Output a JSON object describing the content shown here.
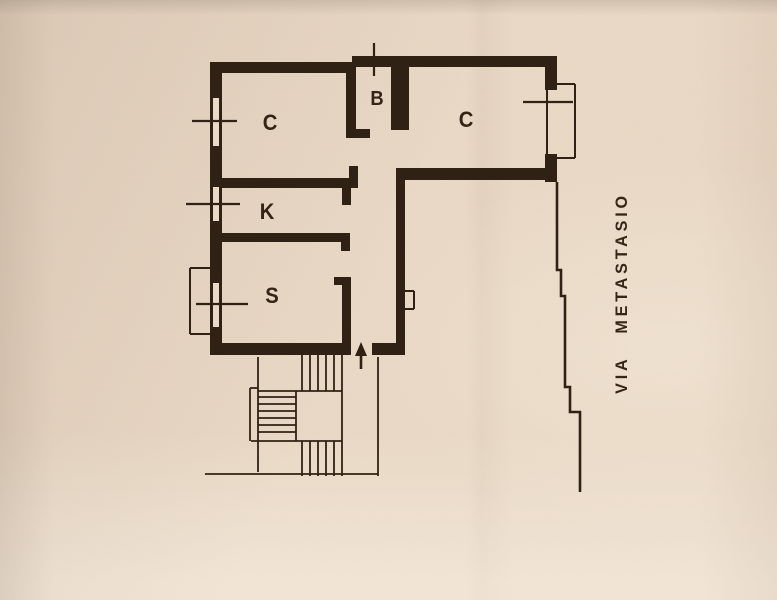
{
  "colors": {
    "paper": "#ead9c6",
    "ink": "#2f2215"
  },
  "street": {
    "label": "VIA METASTASIO"
  },
  "rooms": [
    {
      "id": "room-c-left",
      "label": "C",
      "x": 270,
      "y": 123
    },
    {
      "id": "room-b",
      "label": "B",
      "x": 377,
      "y": 99
    },
    {
      "id": "room-c-right",
      "label": "C",
      "x": 466,
      "y": 120
    },
    {
      "id": "room-k",
      "label": "K",
      "x": 267,
      "y": 212
    },
    {
      "id": "room-s",
      "label": "S",
      "x": 272,
      "y": 296
    }
  ],
  "geometry": {
    "canvas": {
      "w": 777,
      "h": 600
    },
    "walls": [
      [
        210,
        62,
        146,
        11
      ],
      [
        352,
        56,
        205,
        11
      ],
      [
        210,
        62,
        12,
        293
      ],
      [
        210,
        343,
        141,
        12
      ],
      [
        372,
        343,
        33,
        12
      ],
      [
        396,
        168,
        9,
        180
      ],
      [
        396,
        168,
        161,
        12
      ],
      [
        545,
        56,
        12,
        34
      ],
      [
        545,
        154,
        12,
        28
      ],
      [
        391,
        56,
        18,
        74
      ],
      [
        346,
        62,
        10,
        76
      ],
      [
        346,
        129,
        24,
        9
      ],
      [
        222,
        178,
        136,
        10
      ],
      [
        349,
        166,
        9,
        12
      ],
      [
        342,
        188,
        9,
        17
      ],
      [
        222,
        233,
        127,
        9
      ],
      [
        341,
        233,
        9,
        18
      ],
      [
        342,
        277,
        9,
        66
      ],
      [
        334,
        277,
        17,
        8
      ]
    ],
    "window_cutouts": [
      [
        213,
        98,
        6,
        48
      ],
      [
        213,
        187,
        6,
        34
      ],
      [
        213,
        283,
        6,
        44
      ]
    ],
    "window_marks": [
      [
        192,
        121,
        237,
        121
      ],
      [
        186,
        204,
        240,
        204
      ],
      [
        196,
        304,
        248,
        304
      ],
      [
        523,
        102,
        573,
        102
      ],
      [
        374,
        43,
        374,
        76
      ]
    ],
    "bay_lines": [
      [
        546,
        84,
        575,
        84
      ],
      [
        575,
        84,
        575,
        158
      ],
      [
        546,
        158,
        575,
        158
      ],
      [
        547,
        88,
        547,
        154
      ]
    ],
    "balcony_lines": [
      [
        190,
        268,
        214,
        268
      ],
      [
        190,
        268,
        190,
        334
      ],
      [
        190,
        334,
        214,
        334
      ]
    ],
    "niche_lines": [
      [
        405,
        291,
        414,
        291
      ],
      [
        414,
        291,
        414,
        309
      ],
      [
        405,
        309,
        414,
        309
      ]
    ],
    "stair_lines": [
      [
        258,
        357,
        258,
        472
      ],
      [
        342,
        355,
        342,
        476
      ],
      [
        296,
        391,
        296,
        441
      ],
      [
        378,
        357,
        378,
        476
      ],
      [
        258,
        391,
        342,
        391
      ],
      [
        251,
        441,
        342,
        441
      ],
      [
        205,
        474,
        378,
        474
      ],
      [
        250,
        388,
        250,
        441
      ],
      [
        250,
        388,
        258,
        388
      ],
      [
        302,
        355,
        302,
        391
      ],
      [
        310,
        355,
        310,
        391
      ],
      [
        318,
        355,
        318,
        391
      ],
      [
        326,
        355,
        326,
        391
      ],
      [
        334,
        355,
        334,
        391
      ],
      [
        258,
        397,
        296,
        397
      ],
      [
        258,
        404,
        296,
        404
      ],
      [
        258,
        411,
        296,
        411
      ],
      [
        258,
        418,
        296,
        418
      ],
      [
        258,
        425,
        296,
        425
      ],
      [
        258,
        432,
        296,
        432
      ],
      [
        302,
        441,
        302,
        476
      ],
      [
        310,
        441,
        310,
        476
      ],
      [
        318,
        441,
        318,
        476
      ],
      [
        326,
        441,
        326,
        476
      ],
      [
        334,
        441,
        334,
        476
      ]
    ],
    "street_line": [
      [
        557,
        182
      ],
      [
        557,
        270
      ],
      [
        561,
        270
      ],
      [
        561,
        296
      ],
      [
        565,
        296
      ],
      [
        565,
        387
      ],
      [
        570,
        387
      ],
      [
        570,
        412
      ],
      [
        580,
        412
      ],
      [
        580,
        492
      ]
    ],
    "entrance_arrow": {
      "tail": [
        361,
        369
      ],
      "neck": [
        361,
        354
      ],
      "head": [
        [
          361,
          342
        ],
        [
          355,
          356
        ],
        [
          367,
          356
        ]
      ]
    }
  }
}
